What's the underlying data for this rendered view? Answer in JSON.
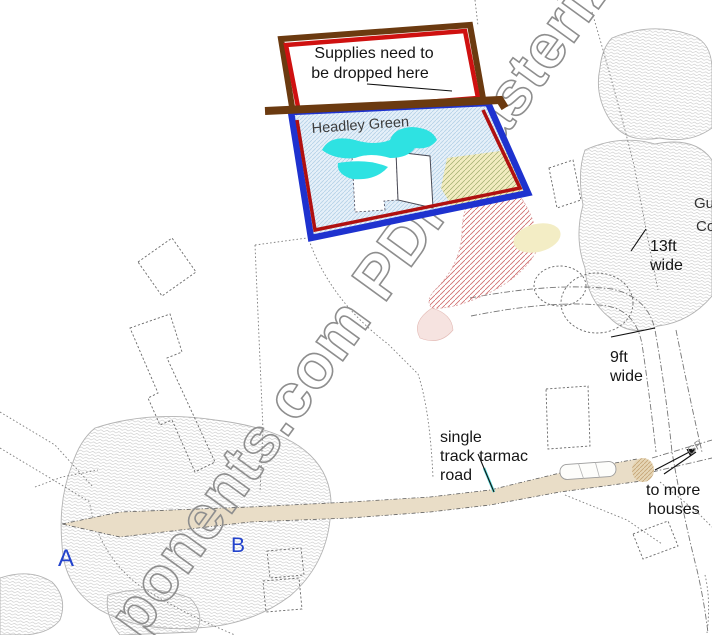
{
  "watermark": {
    "text": "ponents.com PDF Rasteriz"
  },
  "annotations": {
    "supplies": {
      "line1": "Supplies need to",
      "line2": "be dropped here"
    },
    "place_label": "Headley Green",
    "width_13": {
      "line1": "13ft",
      "line2": "wide"
    },
    "width_9": {
      "line1": "9ft",
      "line2": "wide"
    },
    "single_track": {
      "line1": "single",
      "line2": "track tarmac",
      "line3": "road"
    },
    "to_more_houses": {
      "line1": "to more",
      "line2": "houses"
    },
    "point_a": "A",
    "point_b": "B",
    "edge_label_1": "Gu",
    "edge_label_2": "Co",
    "guide_post": "GP"
  },
  "colors": {
    "supplies_border_outer": "#6b3a10",
    "supplies_border_inner": "#cf1110",
    "drop_zone_border_outer": "#1e32cf",
    "drop_zone_border_inner": "#b01010",
    "pond": "#2ee2e2",
    "road_fill": "#e9ddc7",
    "marker_letters": "#2343cc",
    "watermark_gray": "#8e8e8e"
  }
}
